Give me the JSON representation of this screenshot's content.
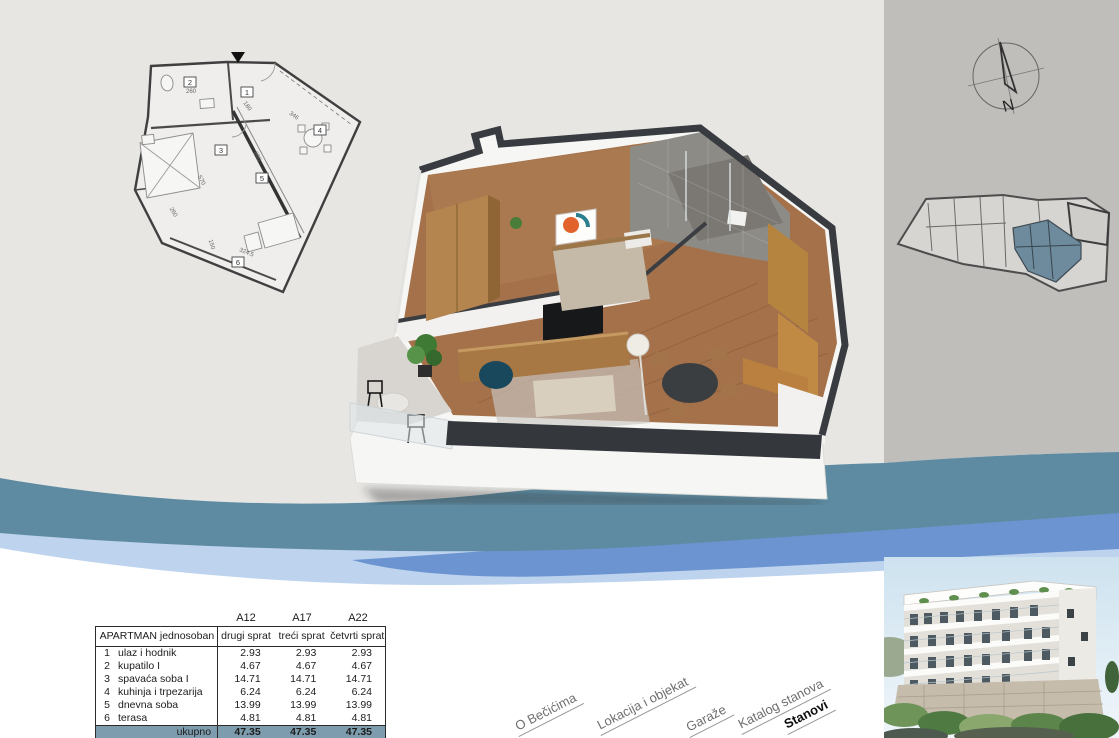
{
  "page": {
    "title": "Katalog stanova - apartman jednosoban"
  },
  "colors": {
    "background_left": "#E7E6E3",
    "panel_right": "#BFBEBB",
    "wave_teal": "#5E8BA1",
    "wave_blue": "#6B94D0",
    "wave_light_blue": "#BDD3EE",
    "table_total_bg": "#7D9CAD",
    "keyplan_highlight": "#6E8B9E"
  },
  "icons": {
    "compass": "north-compass-icon",
    "entry_arrow": "entry-direction-arrow-icon"
  },
  "compass": {
    "north_label": "N"
  },
  "floorplan_2d": {
    "room_numbers": [
      "1",
      "2",
      "3",
      "4",
      "5",
      "6"
    ],
    "dimensions": [
      "260",
      "180",
      "346",
      "570",
      "600",
      "260",
      "150",
      "324.5"
    ]
  },
  "area_table": {
    "unit_columns": [
      "A12",
      "A17",
      "A22"
    ],
    "header": {
      "label": "APARTMAN jednosoban",
      "floors": [
        "drugi sprat",
        "treći sprat",
        "četvrti sprat"
      ]
    },
    "rows": [
      {
        "num": "1",
        "name": "ulaz i hodnik",
        "values": [
          "2.93",
          "2.93",
          "2.93"
        ]
      },
      {
        "num": "2",
        "name": "kupatilo I",
        "values": [
          "4.67",
          "4.67",
          "4.67"
        ]
      },
      {
        "num": "3",
        "name": "spavaća soba I",
        "values": [
          "14.71",
          "14.71",
          "14.71"
        ]
      },
      {
        "num": "4",
        "name": "kuhinja i trpezarija",
        "values": [
          "6.24",
          "6.24",
          "6.24"
        ]
      },
      {
        "num": "5",
        "name": "dnevna soba",
        "values": [
          "13.99",
          "13.99",
          "13.99"
        ]
      },
      {
        "num": "6",
        "name": "terasa",
        "values": [
          "4.81",
          "4.81",
          "4.81"
        ]
      }
    ],
    "total": {
      "label": "ukupno",
      "values": [
        "47.35",
        "47.35",
        "47.35"
      ]
    }
  },
  "nav": {
    "items": [
      {
        "label": "O Bečićima"
      },
      {
        "label": "Lokacija i objekat"
      },
      {
        "label": "Garaže"
      },
      {
        "label": "Katalog stanova"
      },
      {
        "label": "Stanovi"
      }
    ]
  }
}
